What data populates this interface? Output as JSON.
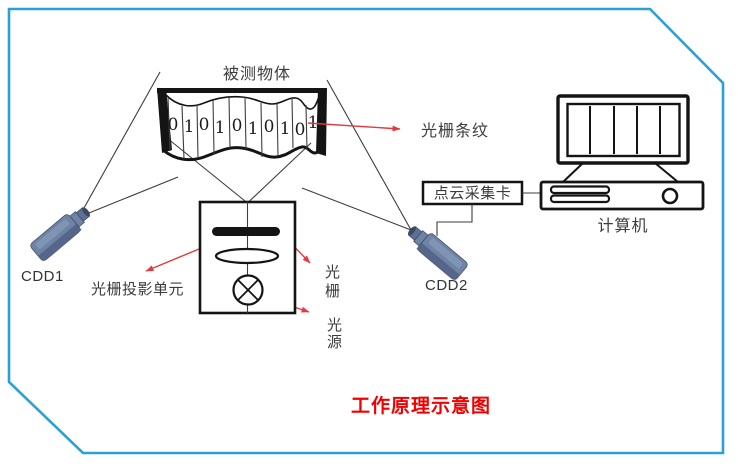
{
  "title": {
    "text": "工作原理示意图"
  },
  "frame": {
    "shape": "rounded-rect-with-cut-corners",
    "color": "#2aa0d4"
  },
  "object_banner": {
    "label": "被测物体",
    "digits": [
      "0",
      "1",
      "0",
      "1",
      "0",
      "1",
      "0",
      "1",
      "0",
      "1"
    ]
  },
  "cameras": {
    "left_label": "CDD1",
    "right_label": "CDD2"
  },
  "projector": {
    "unit_label": "光栅投影单元",
    "grating_chars": [
      "光",
      "栅"
    ],
    "light_source_chars": [
      "光",
      "源"
    ]
  },
  "annotations": {
    "fringe_label": "光栅条纹"
  },
  "computer": {
    "host_label": "计算机",
    "card_label": "点云采集卡"
  },
  "colors": {
    "frame_blue": "#2aa0d4",
    "arrow_red": "#e8383e",
    "title_red": "#f20000",
    "label_text": "#3c3c3c",
    "line_dark": "#3d3d3d",
    "camera_body": "#6f84a4",
    "camera_shade": "#55668a",
    "camera_lens": "#3c4963"
  }
}
